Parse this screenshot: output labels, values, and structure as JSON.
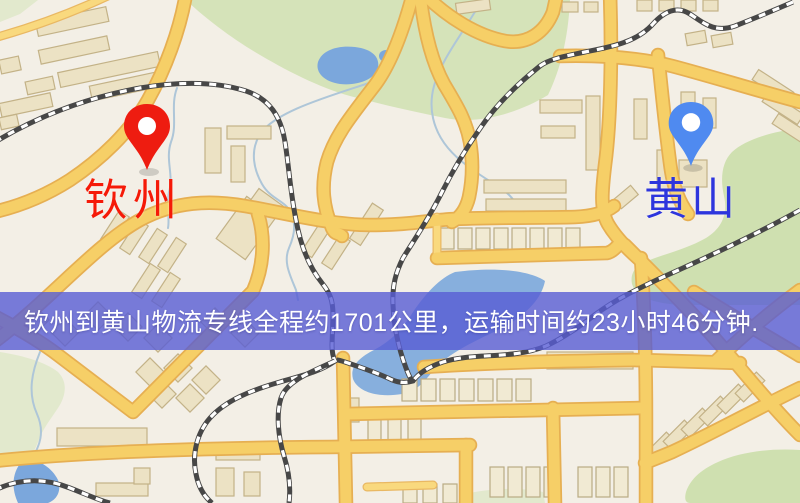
{
  "markers": {
    "origin": {
      "name": "钦州",
      "pin_color": "#ee1c10",
      "label_color": "#f51a08"
    },
    "destination": {
      "name": "黄山",
      "pin_color": "#4f8af0",
      "label_color": "#2d35dd"
    }
  },
  "banner": {
    "text": "钦州到黄山物流专线全程约1701公里，运输时间约23小时46分钟.",
    "background_color": "#585CD4",
    "background_opacity": 0.8,
    "text_color": "#ffffff"
  },
  "map_colors": {
    "land": "#f3efe6",
    "road_fill": "#f6cf67",
    "road_casing": "#e6af52",
    "building": "#ece2c4",
    "building_outline": "#c3b287",
    "park": "#cfe0b0",
    "water": "#7ba7dc",
    "railway_dark": "#474747",
    "railway_light": "#ffffff"
  }
}
